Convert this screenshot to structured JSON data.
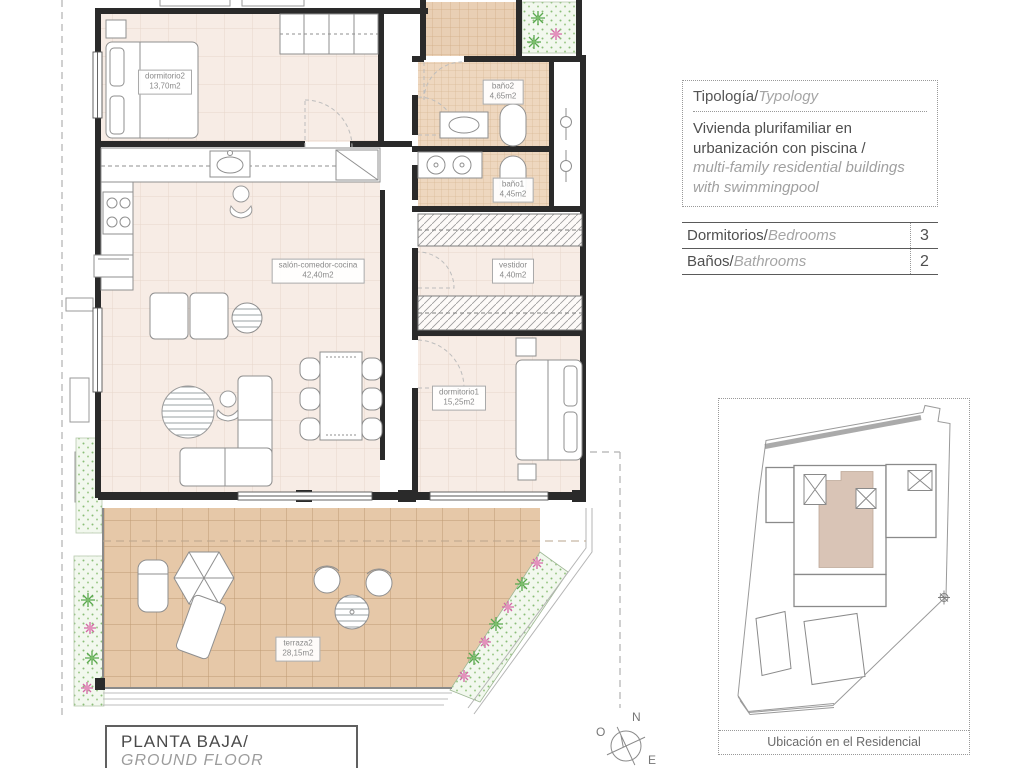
{
  "plan": {
    "rooms": [
      {
        "name": "dormitorio2",
        "area": "13,70m2"
      },
      {
        "name": "baño2",
        "area": "4,65m2"
      },
      {
        "name": "baño1",
        "area": "4,45m2"
      },
      {
        "name": "salón-comedor-cocina",
        "area": "42,40m2"
      },
      {
        "name": "vestidor",
        "area": "4,40m2"
      },
      {
        "name": "dormitorio1",
        "area": "15,25m2"
      },
      {
        "name": "terraza2",
        "area": "28,15m2"
      }
    ],
    "title_es": "PLANTA BAJA/",
    "title_en": "GROUND FLOOR"
  },
  "typology": {
    "title_es": "Tipología/",
    "title_en": "Typology",
    "body_es": "Vivienda plurifamiliar en urbanización con piscina  /",
    "body_en": "multi-family residential buildings with swimmingpool"
  },
  "stats": {
    "rows": [
      {
        "label_es": "Dormitorios/",
        "label_en": "Bedrooms",
        "value": "3"
      },
      {
        "label_es": "Baños/",
        "label_en": "Bathrooms",
        "value": "2"
      }
    ]
  },
  "sitemap": {
    "caption": "Ubicación en el Residencial",
    "highlight_color": "#d9c4b6"
  },
  "compass": {
    "n": "N",
    "o": "O",
    "e": "E"
  },
  "colors": {
    "floor_pink": "#f7ece5",
    "tile_bath": "#eed7bf",
    "tile_terrace": "#e6c8a8",
    "planting_green": "#f2f8ee",
    "wall": "#2a2a2a",
    "unit_highlight": "#d9c4b6"
  }
}
